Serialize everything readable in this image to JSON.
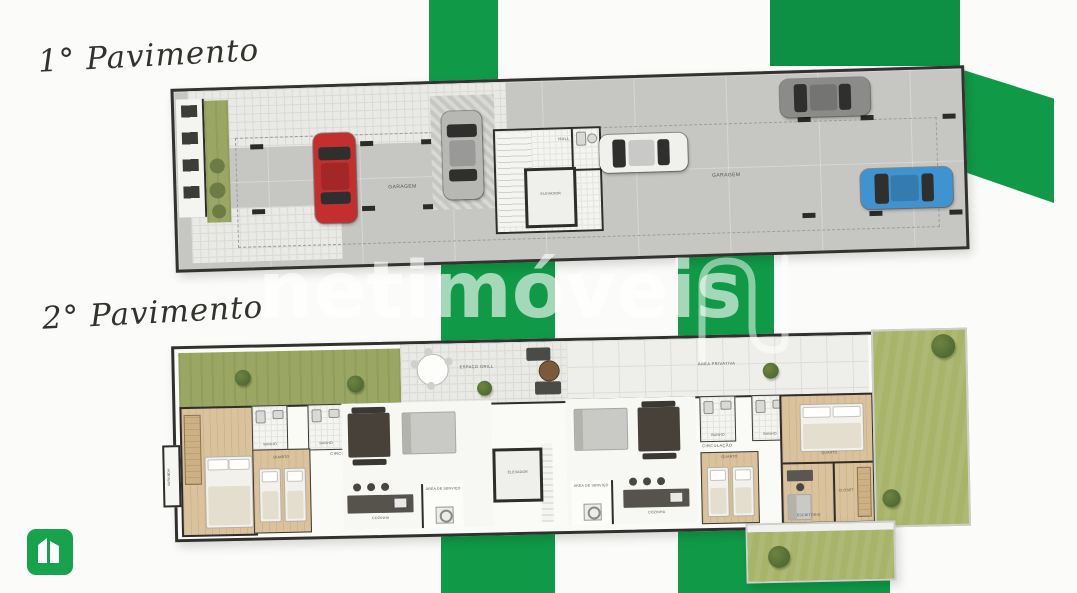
{
  "brand": {
    "watermark": "netimóveis",
    "green": "#109a47",
    "green_dark": "#0d8f44"
  },
  "titles": {
    "floor1": "1° Pavimento",
    "floor2": "2° Pavimento"
  },
  "floor1": {
    "garagem_left": "GARAGEM",
    "garagem_right": "GARAGEM",
    "hall": "HALL",
    "elevador": "ELEVADOR",
    "cars": {
      "red": "#c22f2e",
      "silver": "#b7b7b4",
      "white": "#f0f0ed",
      "gray": "#8b8b89",
      "blue": "#3f93d0"
    }
  },
  "floor2": {
    "area_privativa": "ÁREA PRIVATIVA",
    "espaco_grill": "ESPAÇO GRILL",
    "elevador": "ELEVADOR",
    "left": {
      "varanda": "VARANDA",
      "banho_a": "BANHO",
      "banho_b": "BANHO",
      "circulacao": "CIRCULAÇÃO",
      "quarto": "QUARTO",
      "cozinha": "COZINHA",
      "servico": "ÁREA DE SERVIÇO"
    },
    "right": {
      "banho_a": "BANHO",
      "banho_b": "BANHO",
      "circulacao": "CIRCULAÇÃO",
      "quarto": "QUARTO",
      "cozinha": "COZINHA",
      "servico": "ÁREA DE SERVIÇO",
      "quarto_master": "QUARTO",
      "escritorio": "ESCRITÓRIO",
      "closet": "CLOSET"
    }
  }
}
